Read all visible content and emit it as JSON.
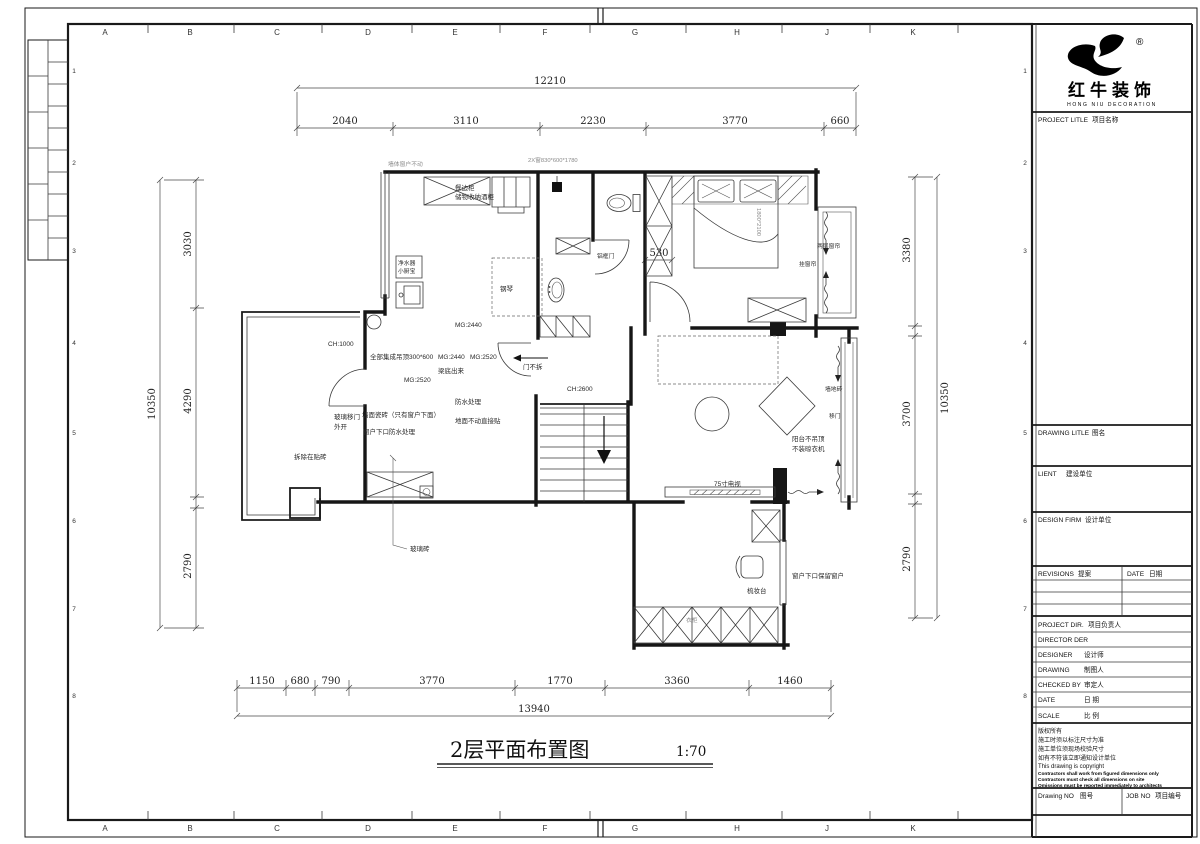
{
  "sheet": {
    "grid_letters": [
      "A",
      "B",
      "C",
      "D",
      "E",
      "F",
      "G",
      "H",
      "J",
      "K"
    ],
    "grid_numbers": [
      "1",
      "2",
      "3",
      "4",
      "5",
      "6",
      "7",
      "8"
    ]
  },
  "drawing_title": {
    "text": "2层平面布置图",
    "scale": "1:70"
  },
  "dims": {
    "top_total": "12210",
    "top": [
      "2040",
      "3110",
      "2230",
      "3770",
      "660"
    ],
    "bottom": [
      "1150",
      "680",
      "790",
      "3770",
      "1770",
      "3360",
      "1460"
    ],
    "bottom_total": "13940",
    "left_total": "10350",
    "left": [
      "3030",
      "4290",
      "2790"
    ],
    "right": [
      "3380",
      "3700",
      "2790"
    ],
    "right_total": "10350",
    "win530": "530"
  },
  "plan": {
    "wall_note": "墙体窗户不动",
    "win_note": "2X窗830*600*1780",
    "sideboard1": "餐边柜",
    "sideboard2": "储物收纳酒柜",
    "purifier": "净水器",
    "kitchen_heater": "小厨宝",
    "ch1000": "CH:1000",
    "ceiling": "全部集成吊顶300*600",
    "mg2440a": "MG:2440",
    "mg2520a": "MG:2520",
    "mg2440b": "MG:2440",
    "mg2520b": "MG:2520",
    "beam": "梁底出来",
    "tile_note": "墙面瓷砖（只有窗户下面）",
    "glass_door": "玻璃移门",
    "open_out": "外开",
    "sill_waterproof": "窗户下口防水处理",
    "waterproof": "防水处理",
    "floor_note": "地面不动直接贴",
    "demolish": "拆除在贴砖",
    "glass_brick": "玻璃砖",
    "piano": "钢琴",
    "alu_door": "铝框门",
    "door_keep": "门不拆",
    "ch2600": "CH:2600",
    "bed_size": "1800*2100",
    "curtain_two": "两层窗帘",
    "curtain_hang": "挂窗帘",
    "wall_tile": "墙地砖",
    "sliding_door": "移门",
    "balcony_note1": "阳台不吊顶",
    "balcony_note2": "不装晾衣机",
    "tv": "75寸电视",
    "dresser": "梳妆台",
    "sill_keep": "窗户下口保留窗户",
    "wardrobe": "衣柜"
  },
  "titleblock": {
    "brand": "红牛装饰",
    "brand_en": "HONG NIU DECORATION",
    "registered": "®",
    "project_title_en": "PROJECT LITLE",
    "project_title_cn": "项目名称",
    "drawing_title_en": "DRAWING LITLE",
    "drawing_title_cn": "图名",
    "client_en": "LIENT",
    "client_cn": "建设单位",
    "design_firm_en": "DESIGN FIRM",
    "design_firm_cn": "设计单位",
    "revisions_en": "REVISIONS",
    "revisions_cn": "提案",
    "rev_date_en": "DATE",
    "rev_date_cn": "日期",
    "project_dir_en": "PROJECT DIR.",
    "project_dir_cn": "项目负责人",
    "director_en": "DIRECTOR DER",
    "director_cn": "",
    "designer_en": "DESIGNER",
    "designer_cn": "设计师",
    "drawing_en": "DRAWING",
    "drawing_cn": "制图人",
    "checked_en": "CHECKED BY",
    "checked_cn": "审定人",
    "date_en": "DATE",
    "date_cn": "日 期",
    "scale_en": "SCALE",
    "scale_cn": "比 例",
    "notes": [
      "版权所有",
      "施工时须以标注尺寸为准",
      "施工单位须现场校验尺寸",
      "如有不符该立即通知设计单位",
      "This drawing is copyright",
      "Contractors shall work from figured dimensions only",
      "Contractors must check all dimensions on site",
      "Omissions must be reported immediately to architects"
    ],
    "drawing_no_en": "Drawing NO",
    "drawing_no_cn": "图号",
    "job_no_en": "JOB NO",
    "job_no_cn": "项目编号"
  }
}
